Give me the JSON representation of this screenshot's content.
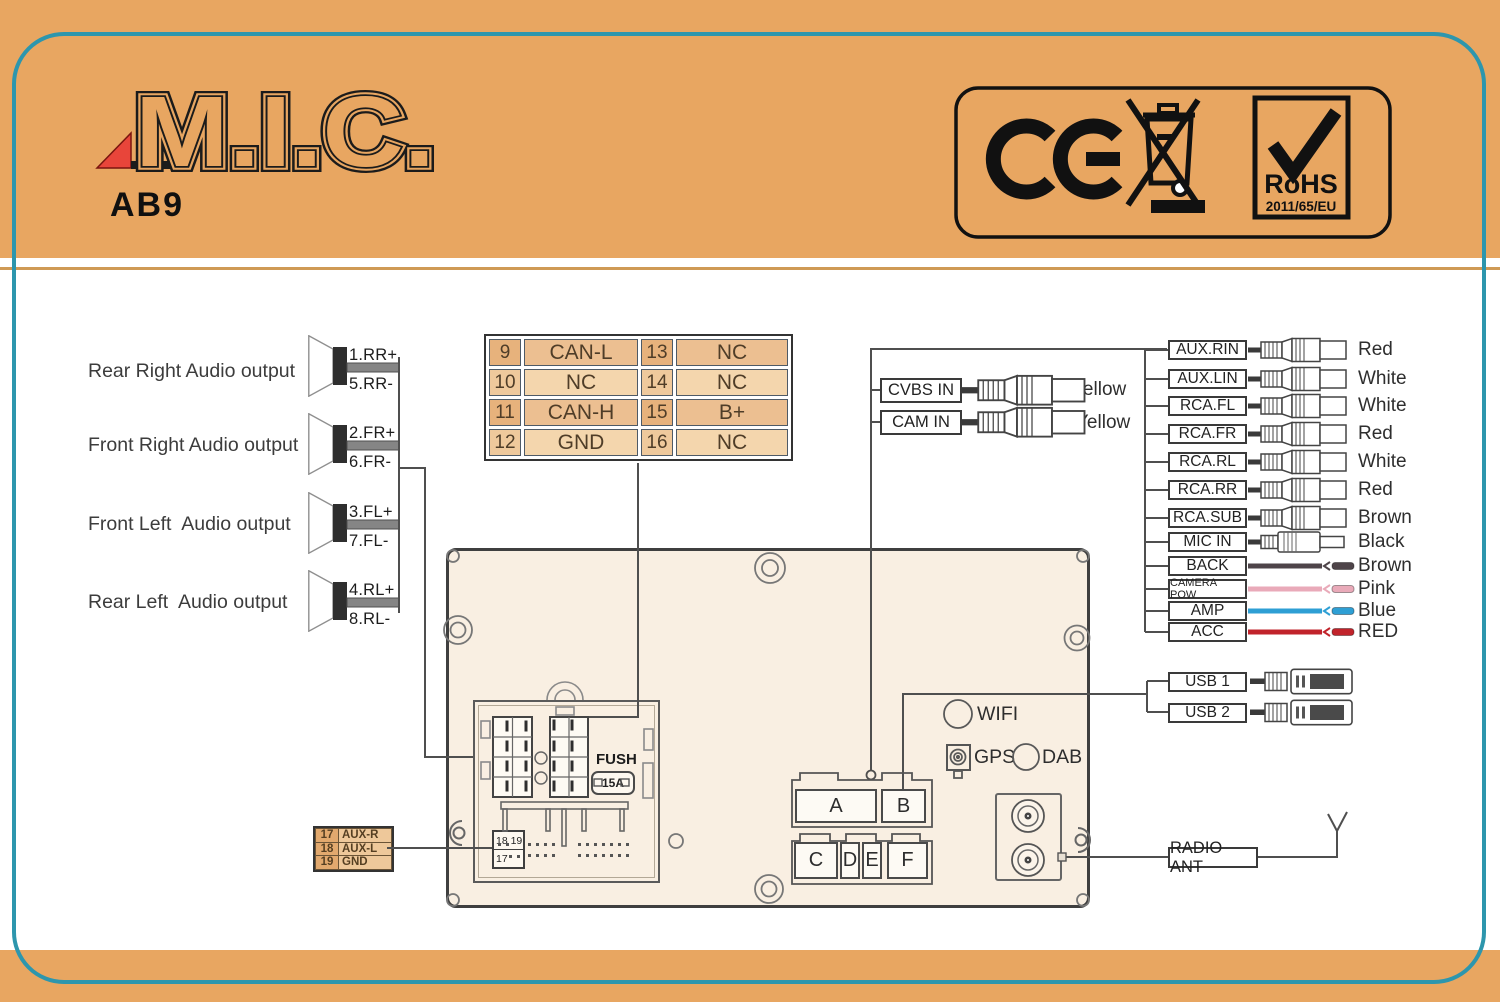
{
  "page": {
    "model": "AB9",
    "brand": "M.I.C."
  },
  "badge": {
    "ce": "CE",
    "rohs": "RoHS",
    "rohs_directive": "2011/65/EU"
  },
  "speakers": {
    "rows": [
      {
        "label": "Rear Right Audio output",
        "pin_plus": "1.RR+",
        "pin_minus": "5.RR-"
      },
      {
        "label": "Front Right Audio output",
        "pin_plus": "2.FR+",
        "pin_minus": "6.FR-"
      },
      {
        "label": "Front Left  Audio output",
        "pin_plus": "3.FL+",
        "pin_minus": "7.FL-"
      },
      {
        "label": "Rear Left  Audio output",
        "pin_plus": "4.RL+",
        "pin_minus": "8.RL-"
      }
    ]
  },
  "pin_table": {
    "rows": [
      {
        "n1": "9",
        "v1": "CAN-L",
        "n2": "13",
        "v2": "NC"
      },
      {
        "n1": "10",
        "v1": "NC",
        "n2": "14",
        "v2": "NC"
      },
      {
        "n1": "11",
        "v1": "CAN-H",
        "n2": "15",
        "v2": "B+"
      },
      {
        "n1": "12",
        "v1": "GND",
        "n2": "16",
        "v2": "NC"
      }
    ]
  },
  "aux_table": {
    "rows": [
      {
        "n": "17",
        "v": "AUX-R"
      },
      {
        "n": "18",
        "v": "AUX-L"
      },
      {
        "n": "19",
        "v": "GND"
      }
    ]
  },
  "video_inputs": {
    "cvbs": {
      "label": "CVBS IN",
      "color": "Yellow"
    },
    "cam": {
      "label": "CAM IN",
      "color": "Yellow"
    }
  },
  "right_ports": {
    "rows": [
      {
        "label": "AUX.RIN",
        "color": "Red",
        "type": "rca"
      },
      {
        "label": "AUX.LIN",
        "color": "White",
        "type": "rca"
      },
      {
        "label": "RCA.FL",
        "color": "White",
        "type": "rca"
      },
      {
        "label": "RCA.FR",
        "color": "Red",
        "type": "rca"
      },
      {
        "label": "RCA.RL",
        "color": "White",
        "type": "rca"
      },
      {
        "label": "RCA.RR",
        "color": "Red",
        "type": "rca"
      },
      {
        "label": "RCA.SUB",
        "color": "Brown",
        "type": "rca"
      },
      {
        "label": "MIC IN",
        "color": "Black",
        "type": "jack"
      },
      {
        "label": "BACK",
        "color": "Brown",
        "type": "wire",
        "wire_hex": "#4e4449"
      },
      {
        "label": "CAMERA POW",
        "color": "Pink",
        "type": "wire",
        "wire_hex": "#e9aab9"
      },
      {
        "label": "AMP",
        "color": "Blue",
        "type": "wire",
        "wire_hex": "#2e9fd4"
      },
      {
        "label": "ACC",
        "color": "RED",
        "type": "wire",
        "wire_hex": "#c1232b"
      }
    ]
  },
  "usb": {
    "usb1": "USB 1",
    "usb2": "USB 2"
  },
  "radio_ant": {
    "label": "RADIO ANT"
  },
  "unit": {
    "pins": {
      "p1": "1",
      "p5": "5",
      "p4": "4",
      "p8": "8",
      "p9": "9",
      "p13": "13",
      "p12": "12",
      "p16": "16"
    },
    "fuse": {
      "label": "FUSH",
      "value": "15A"
    },
    "aux_block": {
      "top": "18 19",
      "bottom": "17"
    },
    "connectors": {
      "a": "A",
      "b": "B",
      "c": "C",
      "d": "D",
      "e": "E",
      "f": "F"
    },
    "wireless": {
      "wifi": "WIFI",
      "gps": "GPS",
      "dab": "DAB"
    }
  },
  "colors": {
    "background": "#e8a661",
    "frame_teal": "#2d96ad",
    "divider_tan": "#cf9a55",
    "table_dark": "#ecbf91",
    "table_light": "#f4d6ad",
    "unit_fill": "#f9efe2",
    "logo_triangle_red": "#e8453a"
  }
}
